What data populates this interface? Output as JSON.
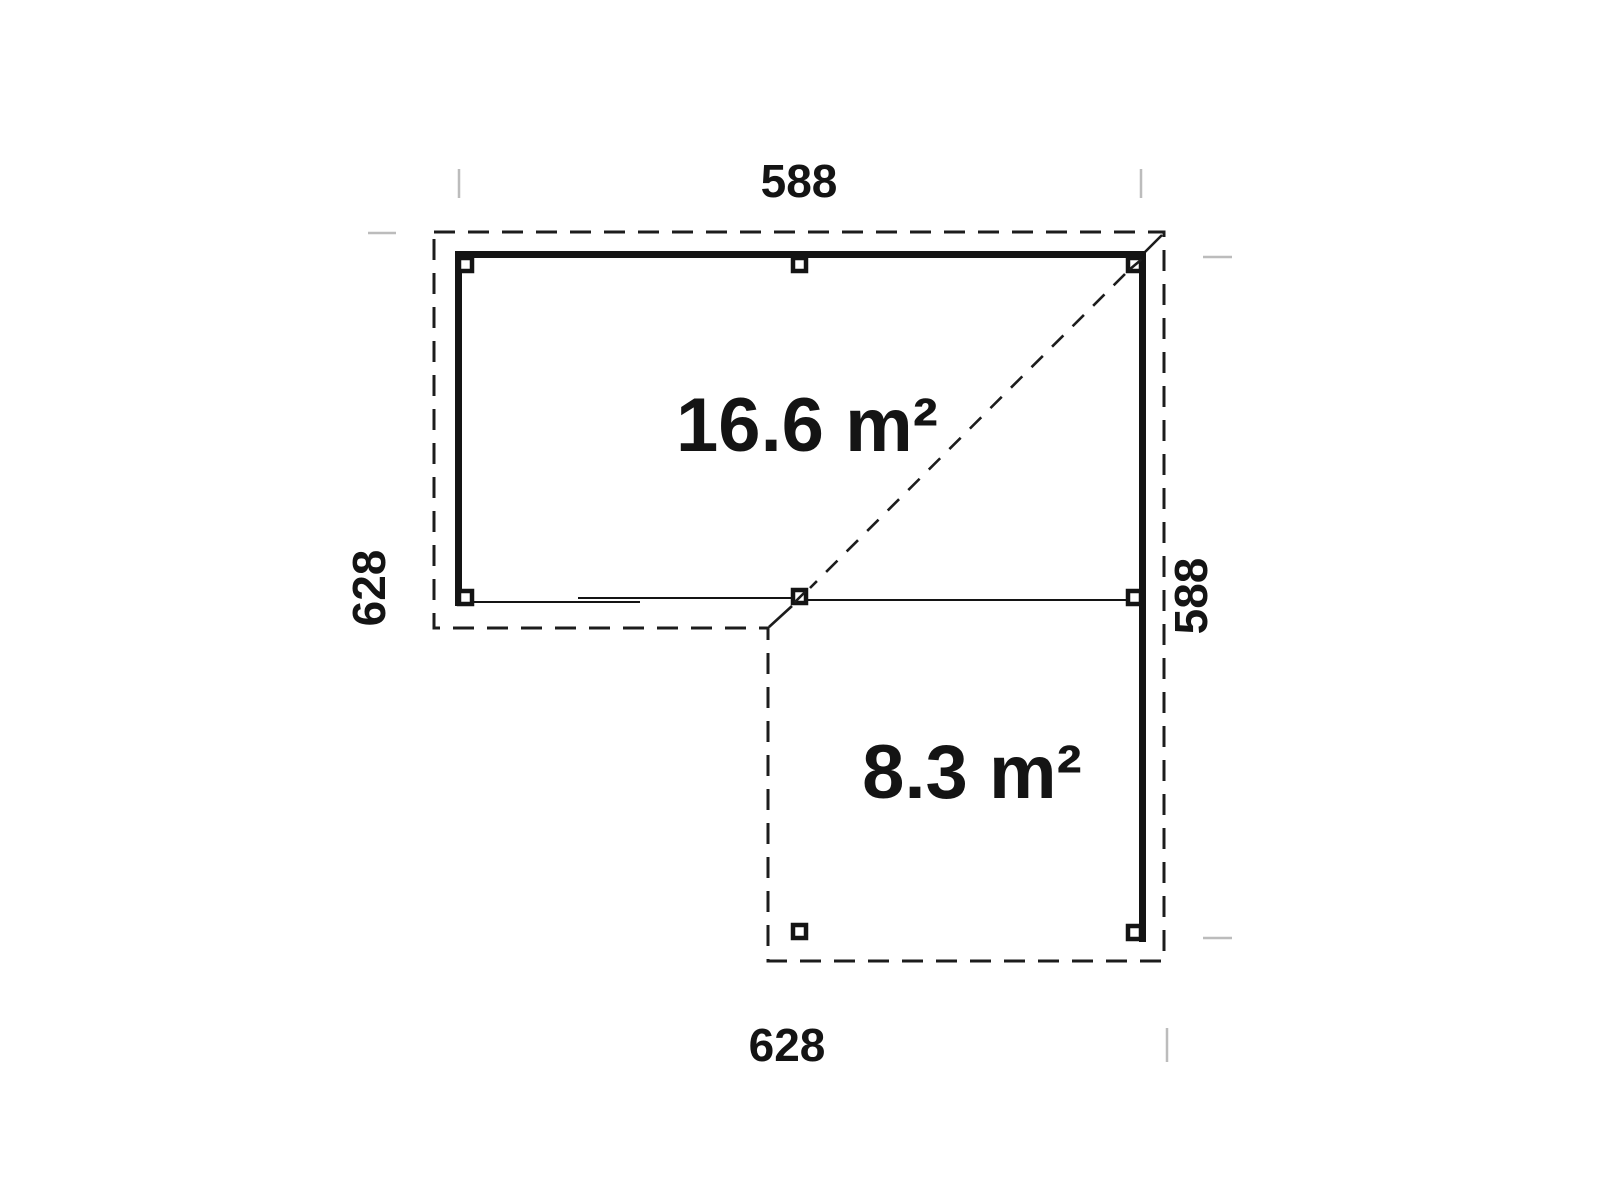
{
  "plan": {
    "title": "L-shaped pavilion floor plan",
    "dimensions": {
      "top": "588",
      "left": "628",
      "right": "588",
      "bottom": "628"
    },
    "areas": {
      "main": "16.6 m²",
      "annex": "8.3 m²"
    },
    "colors": {
      "line": "#141414",
      "dashed_outline": "#1c1c1c",
      "faint_tick": "#bcbcbc",
      "text": "#141414",
      "background": "#ffffff"
    }
  }
}
